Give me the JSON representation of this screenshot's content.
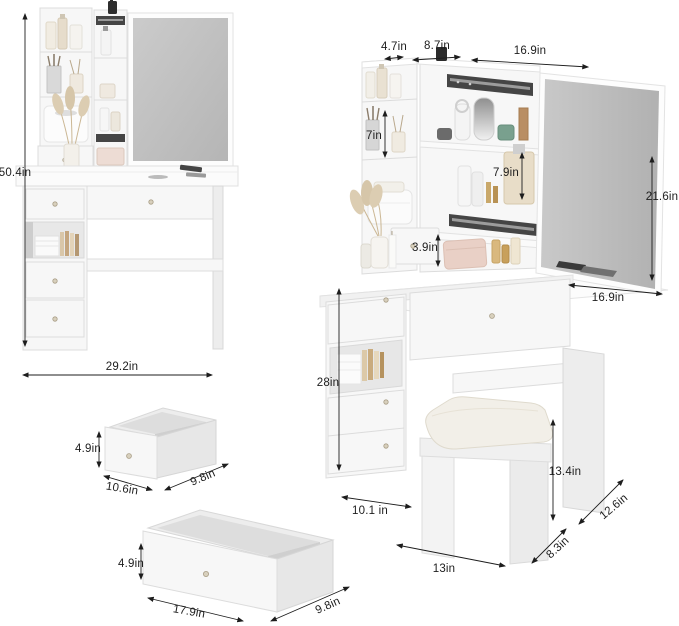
{
  "colors": {
    "background": "#ffffff",
    "ink": "#1d1d1d",
    "mirror": "#c0c0c0",
    "furniture": "#f7f7f7",
    "cushion": "#f2efe8"
  },
  "fig_front": {
    "height": "50.4in",
    "width": "29.2in"
  },
  "fig_side": {
    "top_depth": "4.7in",
    "top_shelf": "8.7in",
    "top_mirror": "16.9in",
    "shelf_h": "7in",
    "mid_shelf_h": "7.9in",
    "mirror_h": "21.6in",
    "drawer_h": "3.9in",
    "desktop_depth": "16.9in",
    "desk_h": "28in",
    "knee": "10.1 in",
    "stool_h": "13.4in",
    "side_depth": "12.6in",
    "stool_depth": "8.3in",
    "stool_w": "13in"
  },
  "fig_small_drawer": {
    "height": "4.9in",
    "width": "10.6in",
    "depth": "9.8in"
  },
  "fig_large_drawer": {
    "height": "4.9in",
    "width": "17.9in",
    "depth": "9.8in"
  }
}
